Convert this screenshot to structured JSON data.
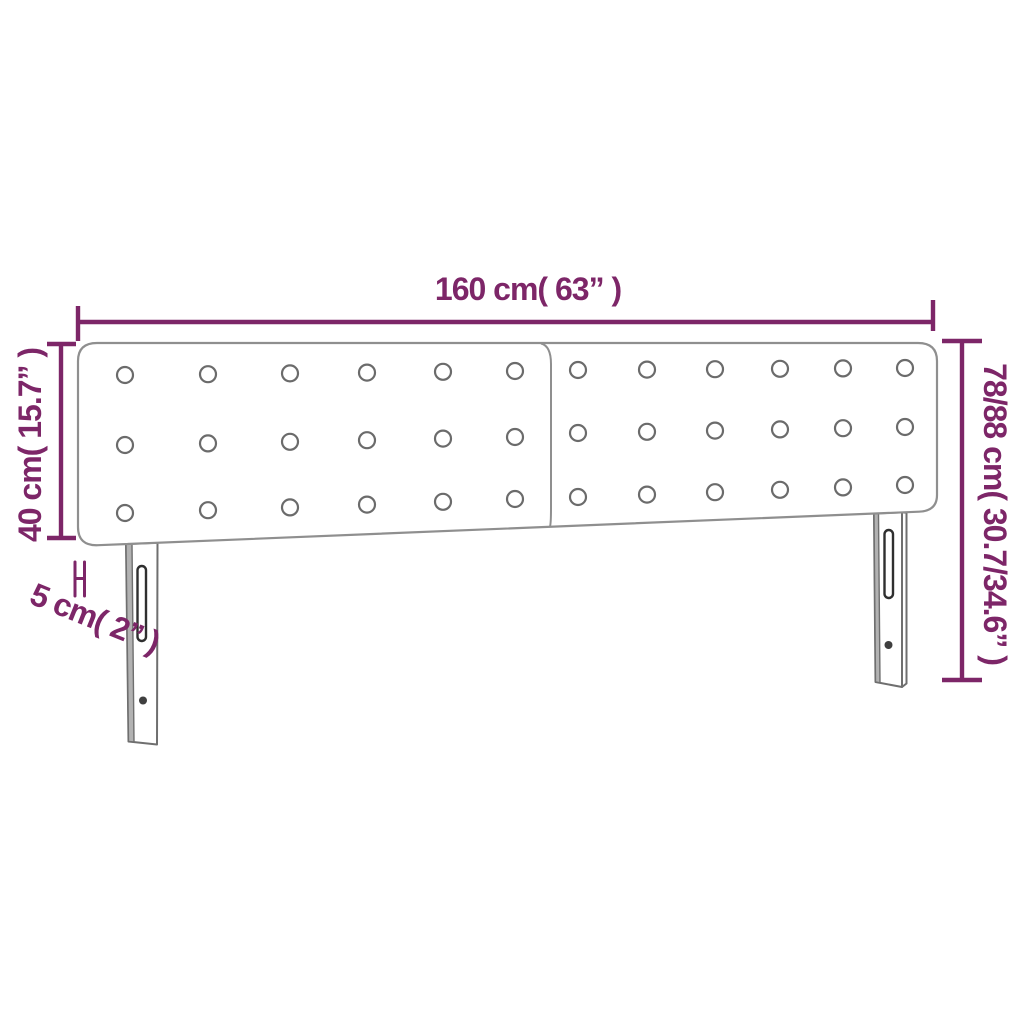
{
  "page": {
    "description": "Product dimension diagram of a two-panel button-tufted headboard with two slotted mounting legs"
  },
  "colors": {
    "accent": "#7d2668",
    "outline_gray": "#8f8f8f"
  },
  "labels": {
    "width": "160 cm( 63” )",
    "panel_height": "40 cm( 15.7” )",
    "depth": "5 cm( 2” )",
    "total_height": "78/88 cm( 30.7/34.6” )"
  },
  "headboard": {
    "panels": 2,
    "button_rows": 3,
    "button_cols_per_panel": 6,
    "legs": 2
  }
}
